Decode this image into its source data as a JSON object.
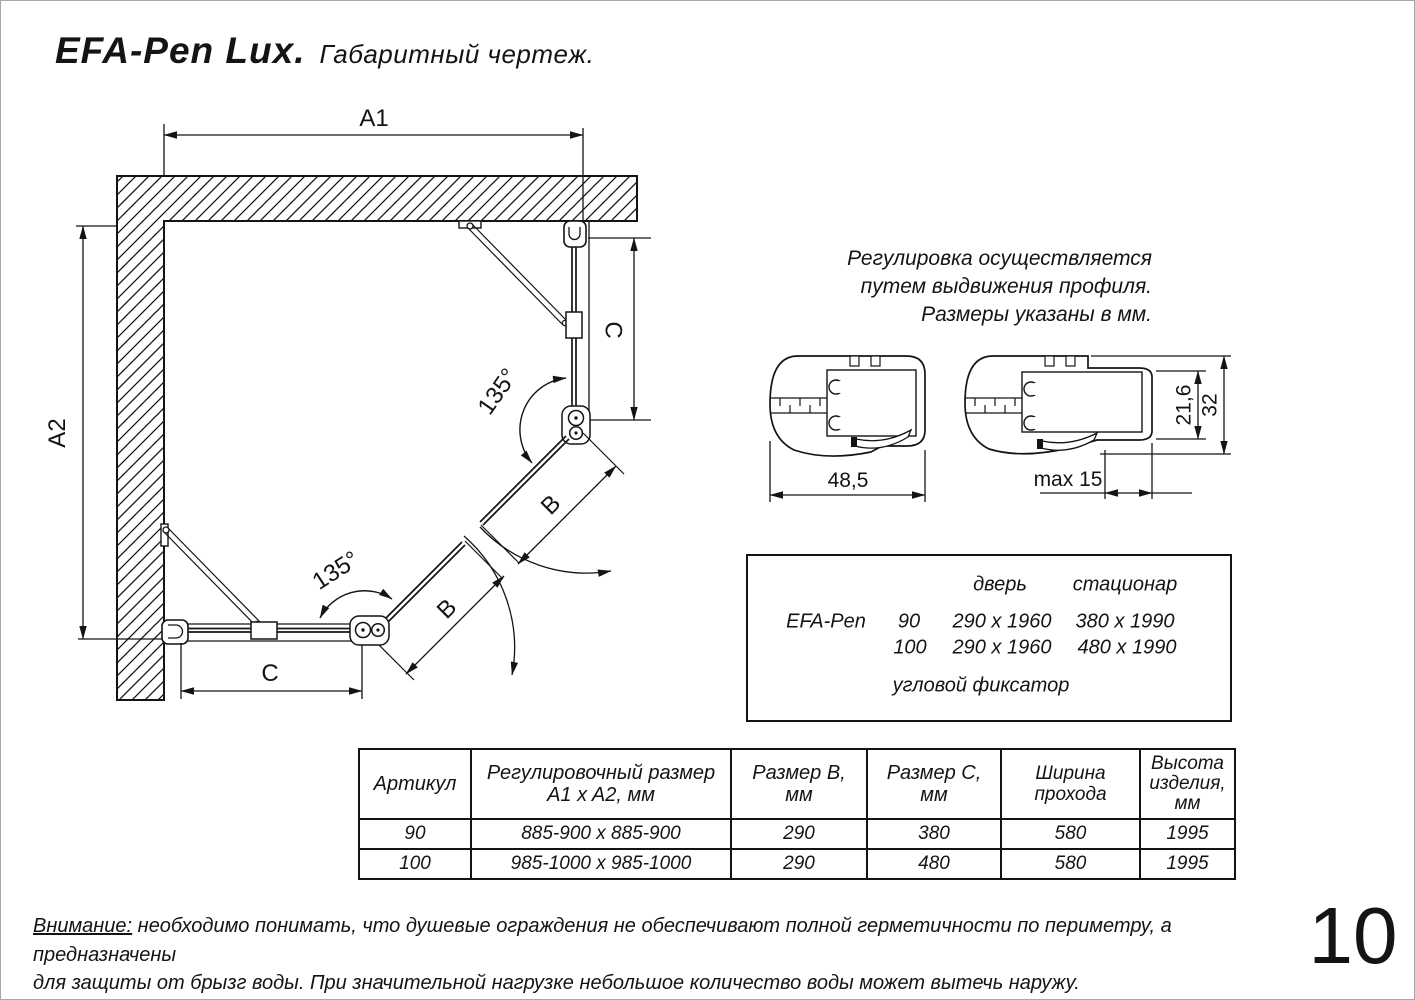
{
  "header": {
    "product": "EFA-Pen Lux.",
    "doc_type": "Габаритный чертеж."
  },
  "plan": {
    "labels": {
      "a1": "A1",
      "a2": "A2",
      "b": "B",
      "c": "C",
      "angle": "135°"
    }
  },
  "adjustment_note": {
    "line1": "Регулировка осуществляется",
    "line2": "путем выдвижения профиля.",
    "line3": "Размеры указаны в мм."
  },
  "profiles": {
    "closed_width": "48,5",
    "extension": "max 15",
    "glass_depth": "21,6",
    "profile_height": "32"
  },
  "spec_box": {
    "door_header": "дверь",
    "fixed_header": "стационар",
    "model": "EFA-Pen",
    "rows": [
      {
        "size": "90",
        "door": "290 x 1960",
        "fixed": "380 x 1990"
      },
      {
        "size": "100",
        "door": "290 x 1960",
        "fixed": "480 x 1990"
      }
    ],
    "note": "угловой фиксатор"
  },
  "size_table": {
    "headers": [
      "Артикул",
      "Регулировочный размер\nA1 x A2, мм",
      "Размер B, мм",
      "Размер C, мм",
      "Ширина\nпрохода",
      "Высота\nизделия,\nмм"
    ],
    "rows": [
      [
        "90",
        "885-900 x 885-900",
        "290",
        "380",
        "580",
        "1995"
      ],
      [
        "100",
        "985-1000 x 985-1000",
        "290",
        "480",
        "580",
        "1995"
      ]
    ]
  },
  "warning": {
    "label": "Внимание:",
    "line1_rest": " необходимо понимать, что душевые ограждения не обеспечивают полной герметичности по периметру, а предназначены",
    "line2": "для защиты от брызг воды. При значительной нагрузке небольшое количество воды может вытечь наружу."
  },
  "page_number": "10"
}
